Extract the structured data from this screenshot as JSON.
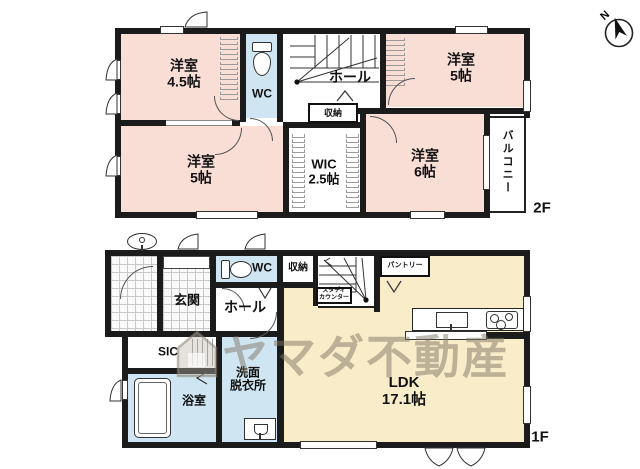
{
  "watermark": {
    "text": "ヤマダ不動産"
  },
  "compass": {
    "north_label": "N"
  },
  "floor2": {
    "floor_label": "2F",
    "bedroom_45": {
      "name": "洋室",
      "size": "4.5帖"
    },
    "bedroom_5_top": {
      "name": "洋室",
      "size": "5帖"
    },
    "bedroom_5_left": {
      "name": "洋室",
      "size": "5帖"
    },
    "bedroom_6": {
      "name": "洋室",
      "size": "6帖"
    },
    "wic": {
      "name": "WIC",
      "size": "2.5帖"
    },
    "wc": {
      "label": "WC"
    },
    "hall": {
      "label": "ホール"
    },
    "storage": {
      "label": "収納"
    },
    "balcony": {
      "label": "バルコニー"
    }
  },
  "floor1": {
    "floor_label": "1F",
    "entrance": {
      "label": "玄関"
    },
    "hall": {
      "label": "ホール"
    },
    "wc": {
      "label": "WC"
    },
    "storage": {
      "label": "収納"
    },
    "pantry": {
      "label": "パントリー"
    },
    "study_counter": {
      "line1": "スタディ",
      "line2": "カウンター"
    },
    "sic": {
      "label": "SIC"
    },
    "washroom": {
      "line1": "洗面",
      "line2": "脱衣所"
    },
    "bathroom": {
      "label": "浴室"
    },
    "ldk": {
      "name": "LDK",
      "size": "17.1帖"
    }
  },
  "colors": {
    "wall": "#1b1b1b",
    "bedroom_fill": "#f9ded6",
    "wet_area_fill": "#cfe6f2",
    "ldk_fill": "#f9ecc9",
    "watermark": "#80766a"
  }
}
